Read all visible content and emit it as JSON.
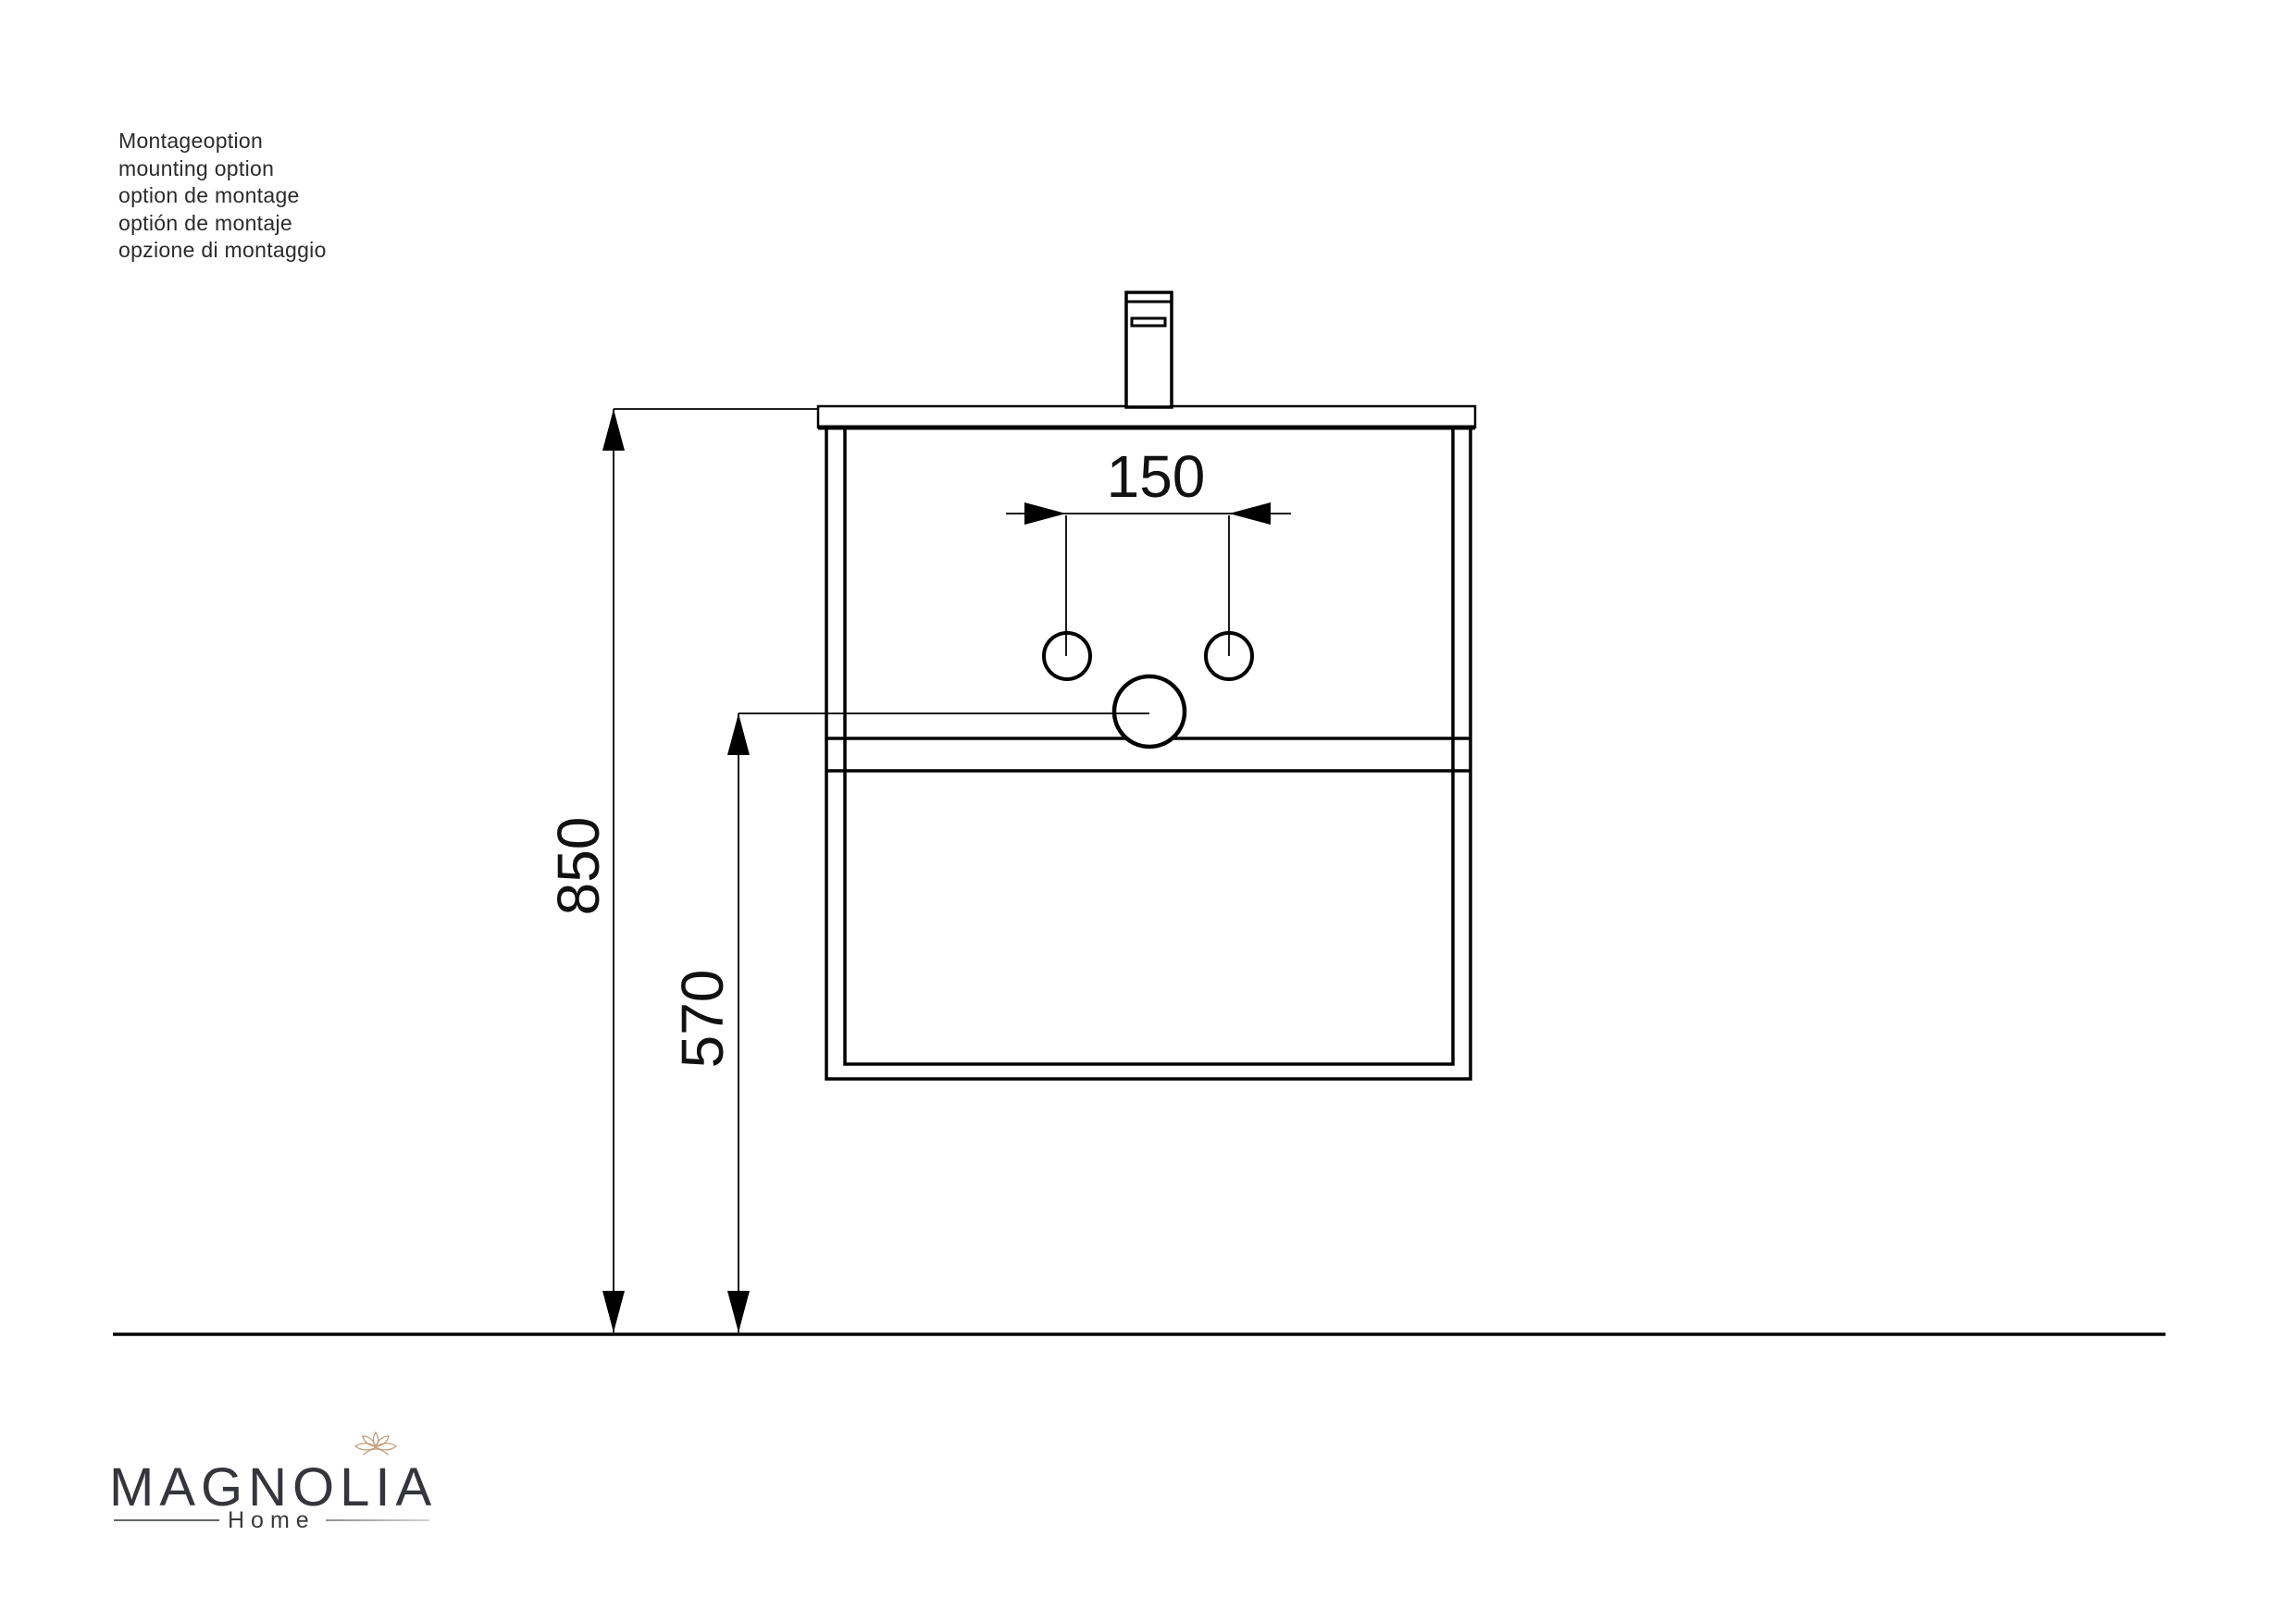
{
  "note": {
    "lines": [
      "Montageoption",
      "mounting option",
      "option de montage",
      "optión de montaje",
      "opzione di montaggio"
    ]
  },
  "dims": {
    "hole_spacing": "150",
    "mount_height": "850",
    "drain_height": "570"
  },
  "logo": {
    "brand": "MAGNOLIA",
    "subtitle": "Home",
    "flower_icon": "lotus-flower-icon"
  },
  "colors": {
    "drawing_line": "#000000",
    "logo_text": "#35363b",
    "flower_accent": "#c2a07e",
    "background": "#ffffff"
  }
}
